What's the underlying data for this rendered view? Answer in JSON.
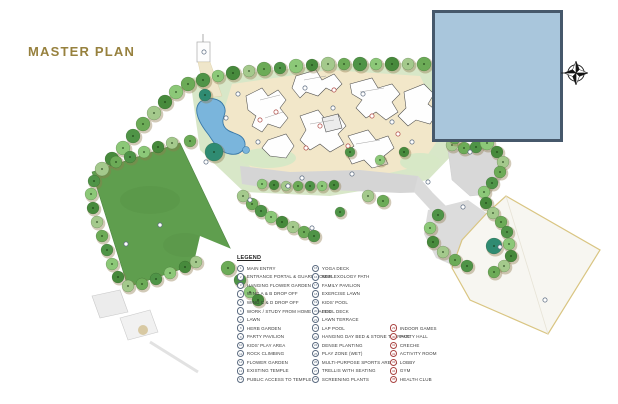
{
  "title": "MASTER PLAN",
  "legend": {
    "header": "LEGEND",
    "columns": [
      {
        "marker_color": "#5b6b80",
        "items": [
          {
            "n": "1",
            "label": "MAIN ENTRY"
          },
          {
            "n": "2",
            "label": "ENTRANCE PORTAL & GUARD HOUSE"
          },
          {
            "n": "3",
            "label": "HANGING FLOWER GARDEN"
          },
          {
            "n": "4",
            "label": "WING A & B DROP OFF"
          },
          {
            "n": "5",
            "label": "WING C & D DROP OFF"
          },
          {
            "n": "6",
            "label": "WORK / STUDY FROM HOME SPACES"
          },
          {
            "n": "7",
            "label": "LAWN"
          },
          {
            "n": "8",
            "label": "HERB GARDEN"
          },
          {
            "n": "9",
            "label": "PARTY PAVILION"
          },
          {
            "n": "10",
            "label": "KIDS' PLAY AREA"
          },
          {
            "n": "11",
            "label": "ROCK CLIMBING"
          },
          {
            "n": "12",
            "label": "FLOWER GARDEN"
          },
          {
            "n": "13",
            "label": "EXISTING TEMPLE"
          },
          {
            "n": "14",
            "label": "PUBLIC ACCESS TO TEMPLE"
          }
        ]
      },
      {
        "marker_color": "#5b6b80",
        "items": [
          {
            "n": "15",
            "label": "YOGA DECK"
          },
          {
            "n": "16",
            "label": "REFLEXOLOGY PATH"
          },
          {
            "n": "17",
            "label": "FAMILY PAVILION"
          },
          {
            "n": "18",
            "label": "EXERCISE LAWN"
          },
          {
            "n": "19",
            "label": "KIDS' POOL"
          },
          {
            "n": "20",
            "label": "POOL DECK"
          },
          {
            "n": "21",
            "label": "LAWN TERRACE"
          },
          {
            "n": "22",
            "label": "LAP POOL"
          },
          {
            "n": "23",
            "label": "HANGING DAY BED & STONE TERRACE"
          },
          {
            "n": "24",
            "label": "DENSE PLANTING"
          },
          {
            "n": "25",
            "label": "PLAY ZONE (WET)"
          },
          {
            "n": "26",
            "label": "MULTI-PURPOSE SPORTS ARENA"
          },
          {
            "n": "27",
            "label": "TRELLIS WITH SEATING"
          },
          {
            "n": "28",
            "label": "SCREENING PLANTS"
          }
        ]
      },
      {
        "marker_color": "#a94442",
        "items": [
          {
            "n": "29",
            "label": "INDOOR GAMES"
          },
          {
            "n": "30",
            "label": "PARTY HALL"
          },
          {
            "n": "31",
            "label": "CRECHE"
          },
          {
            "n": "32",
            "label": "ACTIVITY ROOM"
          },
          {
            "n": "33",
            "label": "LOBBY"
          },
          {
            "n": "34",
            "label": "GYM"
          },
          {
            "n": "35",
            "label": "HEALTH CLUB"
          }
        ]
      }
    ]
  },
  "colors": {
    "title": "#97813e",
    "overlay_fill": "#a9c6dc",
    "overlay_border": "#46586b",
    "lawn": "#5f9e4e",
    "field": "#d8e7c8",
    "path_cream": "#f2e7c9",
    "pool": "#7ab5dc",
    "road": "#d5d5d5",
    "parcel_border": "#d9c582"
  },
  "compass": {
    "type": "north-arrow"
  }
}
